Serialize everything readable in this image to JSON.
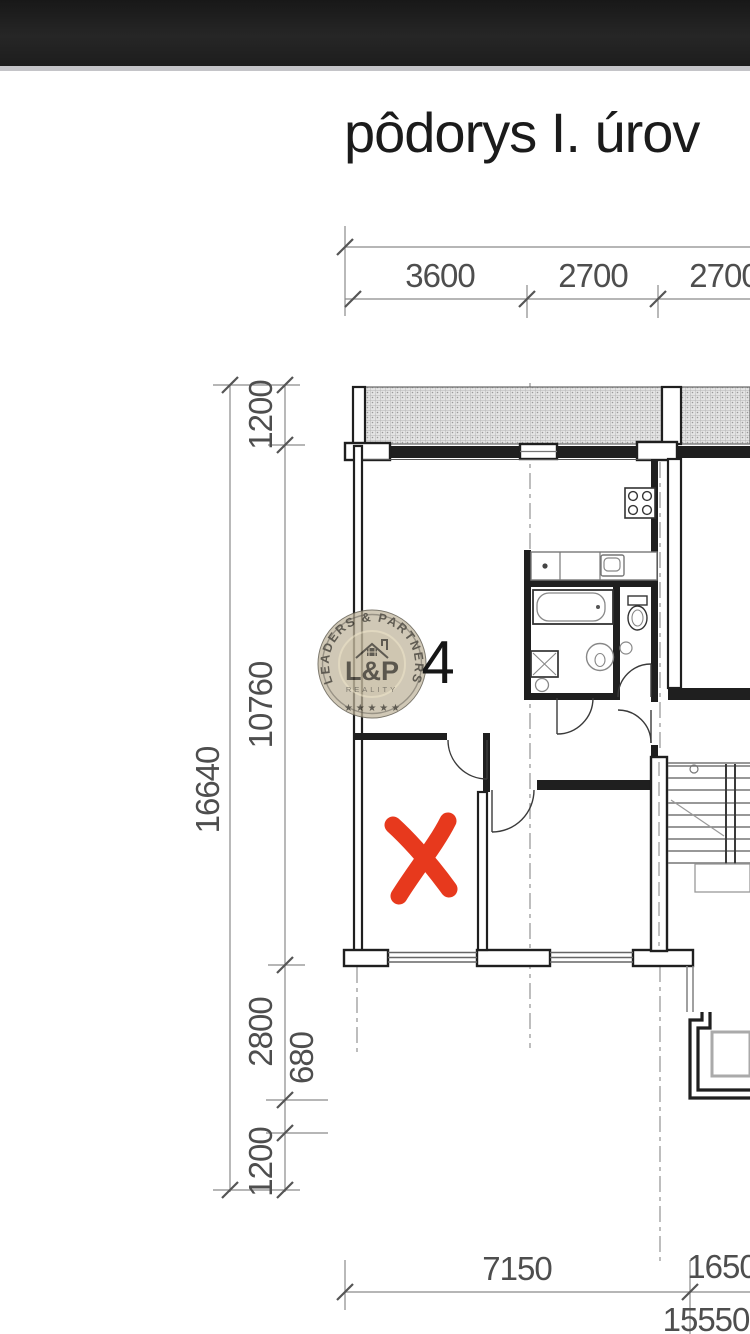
{
  "title": "pôdorys I. úrov",
  "plan": {
    "room_number": "4",
    "dimensions": {
      "top": [
        "3600",
        "2700",
        "2700"
      ],
      "left_overall": "16640",
      "left_segments": [
        "1200",
        "10760",
        "2800",
        "680",
        "1200"
      ],
      "bottom": [
        "7150",
        "1650"
      ],
      "bottom_overall": "15550"
    }
  },
  "watermark": {
    "arc_text": "LEADERS & PARTNERS",
    "monogram": "L&P",
    "subtitle": "REALITY",
    "stars": "★ ★ ★ ★ ★"
  },
  "colors": {
    "annotation_red": "#e7391d",
    "watermark_tan": "#beb39a",
    "wall_black": "#1f1f1f",
    "dim_gray": "#8a8a8a"
  }
}
